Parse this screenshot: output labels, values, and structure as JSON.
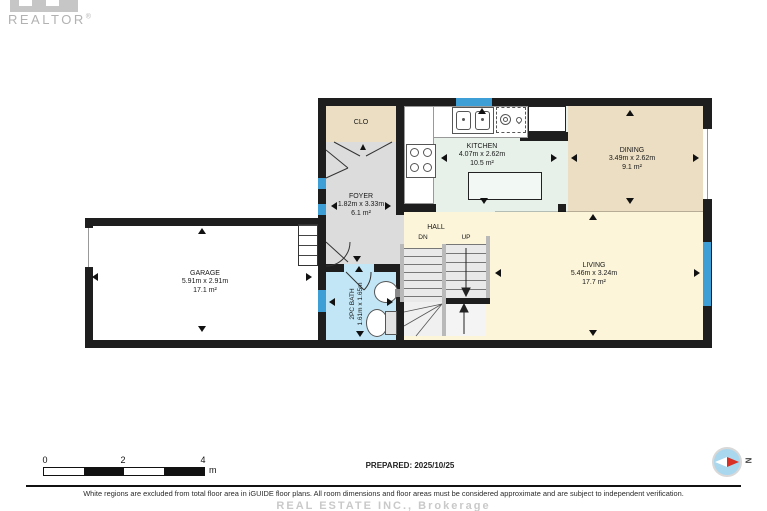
{
  "branding": {
    "realtor": "REALTOR",
    "reg": "®"
  },
  "rooms": {
    "closet": {
      "name": "CLO"
    },
    "foyer": {
      "name": "FOYER",
      "dims": "1.82m x 3.33m",
      "area": "6.1 m²"
    },
    "kitchen": {
      "name": "KITCHEN",
      "dims": "4.07m x 2.62m",
      "area": "10.5 m²"
    },
    "dining": {
      "name": "DINING",
      "dims": "3.49m x 2.62m",
      "area": "9.1 m²"
    },
    "living": {
      "name": "LIVING",
      "dims": "5.46m x 3.24m",
      "area": "17.7 m²"
    },
    "garage": {
      "name": "GARAGE",
      "dims": "5.91m x 2.91m",
      "area": "17.1 m²"
    },
    "bath": {
      "name": "2PC BATH",
      "dims": "1.61m x 1.65m"
    },
    "hall": {
      "name": "HALL",
      "dn": "DN",
      "up": "UP"
    }
  },
  "scale": {
    "t0": "0",
    "t2": "2",
    "t4": "4",
    "unit": "m"
  },
  "prepared_label": "PREPARED: 2025/10/25",
  "compass": {
    "n": "N"
  },
  "footer": {
    "disclaimer": "White regions are excluded from total floor area in iGUIDE floor plans. All room dimensions and floor areas must be considered approximate and are subject to independent verification.",
    "watermark": "REAL ESTATE INC., Brokerage"
  },
  "colors": {
    "wall": "#1e1e1e",
    "window": "#3e9ed6",
    "kitchen": "#e7f1ea",
    "dining": "#ebdec2",
    "living": "#fcf5da",
    "foyer": "#dcdcdc",
    "bath": "#c2e6f5",
    "garage": "#ffffff",
    "compass": "#a9d7ee",
    "red": "#d93025"
  }
}
